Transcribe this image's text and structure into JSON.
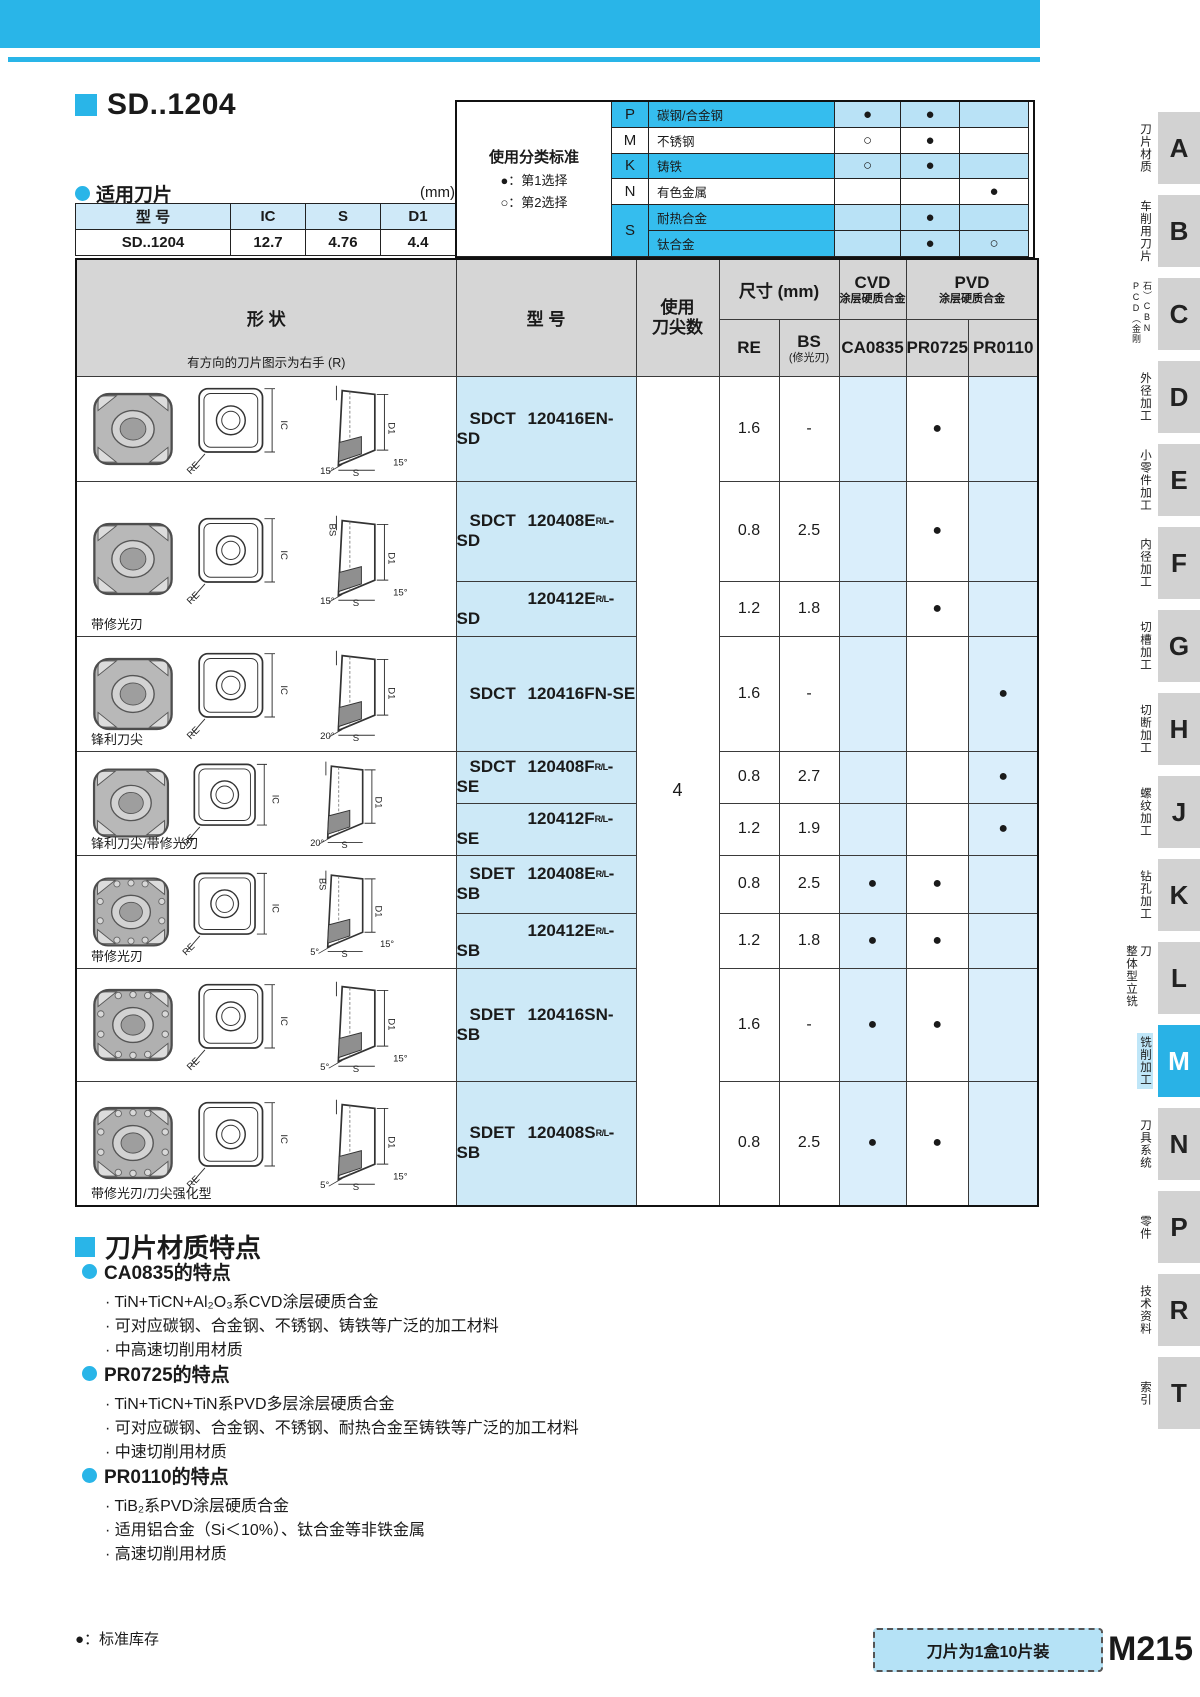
{
  "title": {
    "heading": "SD..1204",
    "applicable_label": "适用刀片",
    "unit": "(mm)"
  },
  "applicable_table": {
    "headers": [
      "型  号",
      "IC",
      "S",
      "D1"
    ],
    "row": [
      "SD..1204",
      "12.7",
      "4.76",
      "4.4"
    ]
  },
  "classification": {
    "title": "使用分类标准",
    "legend1": "●：第1选择",
    "legend2": "○：第2选择",
    "rows": [
      {
        "letter": "P",
        "label": "碳钢/合金钢",
        "marks": [
          "●",
          "●",
          ""
        ]
      },
      {
        "letter": "M",
        "label": "不锈钢",
        "marks": [
          "○",
          "●",
          ""
        ]
      },
      {
        "letter": "K",
        "label": "铸铁",
        "marks": [
          "○",
          "●",
          ""
        ]
      },
      {
        "letter": "N",
        "label": "有色金属",
        "marks": [
          "",
          "",
          "●"
        ]
      },
      {
        "letter": "S",
        "label": "耐热合金",
        "marks": [
          "",
          "●",
          ""
        ]
      },
      {
        "letter": "",
        "label": "钛合金",
        "marks": [
          "",
          "●",
          "○"
        ]
      }
    ]
  },
  "main_table": {
    "headers": {
      "shape": "形  状",
      "shape_note": "有方向的刀片图示为右手 (R)",
      "model": "型  号",
      "tips1": "使用",
      "tips2": "刀尖数",
      "size": "尺寸 (mm)",
      "re": "RE",
      "bs": "BS",
      "bs_sub": "(修光刃)",
      "cvd": "CVD",
      "cvd_sub": "涂层硬质合金",
      "pvd": "PVD",
      "pvd_sub": "涂层硬质合金",
      "ca": "CA0835",
      "p725": "PR0725",
      "p110": "PR0110"
    },
    "tips_value": "4",
    "drawing_labels": {
      "re": "RE",
      "ic": "IC",
      "d1": "D1",
      "s": "S"
    },
    "groups": [
      {
        "label": "",
        "bs_label": "",
        "angle_a": "15°",
        "angle_b": "15°",
        "rows": [
          {
            "prefix": "SDCT",
            "code": "120416EN-SD",
            "rl": "",
            "suffix": "",
            "re": "1.6",
            "bs": "-",
            "ca": "",
            "p725": "●",
            "p110": ""
          }
        ]
      },
      {
        "label": "带修光刃",
        "bs_label": "BS",
        "angle_a": "15°",
        "angle_b": "15°",
        "rows": [
          {
            "prefix": "SDCT",
            "code": "120408E",
            "rl": "R/L",
            "suffix": "-SD",
            "re": "0.8",
            "bs": "2.5",
            "ca": "",
            "p725": "●",
            "p110": ""
          },
          {
            "prefix": "",
            "code": "120412E",
            "rl": "R/L",
            "suffix": "-SD",
            "re": "1.2",
            "bs": "1.8",
            "ca": "",
            "p725": "●",
            "p110": ""
          }
        ]
      },
      {
        "label": "锋利刀尖",
        "bs_label": "",
        "angle_a": "20°",
        "angle_b": "",
        "rows": [
          {
            "prefix": "SDCT",
            "code": "120416FN-SE",
            "rl": "",
            "suffix": "",
            "re": "1.6",
            "bs": "-",
            "ca": "",
            "p725": "",
            "p110": "●"
          }
        ]
      },
      {
        "label": "锋利刀尖/带修光刃",
        "bs_label": "",
        "angle_a": "20°",
        "angle_b": "",
        "rows": [
          {
            "prefix": "SDCT",
            "code": "120408F",
            "rl": "R/L",
            "suffix": "-SE",
            "re": "0.8",
            "bs": "2.7",
            "ca": "",
            "p725": "",
            "p110": "●"
          },
          {
            "prefix": "",
            "code": "120412F",
            "rl": "R/L",
            "suffix": "-SE",
            "re": "1.2",
            "bs": "1.9",
            "ca": "",
            "p725": "",
            "p110": "●"
          }
        ]
      },
      {
        "label": "带修光刃",
        "bs_label": "BS",
        "angle_a": "5°",
        "angle_b": "15°",
        "rows": [
          {
            "prefix": "SDET",
            "code": "120408E",
            "rl": "R/L",
            "suffix": "-SB",
            "re": "0.8",
            "bs": "2.5",
            "ca": "●",
            "p725": "●",
            "p110": ""
          },
          {
            "prefix": "",
            "code": "120412E",
            "rl": "R/L",
            "suffix": "-SB",
            "re": "1.2",
            "bs": "1.8",
            "ca": "●",
            "p725": "●",
            "p110": ""
          }
        ]
      },
      {
        "label": "",
        "bs_label": "",
        "angle_a": "5°",
        "angle_b": "15°",
        "rows": [
          {
            "prefix": "SDET",
            "code": "120416SN-SB",
            "rl": "",
            "suffix": "",
            "re": "1.6",
            "bs": "-",
            "ca": "●",
            "p725": "●",
            "p110": ""
          }
        ]
      },
      {
        "label": "带修光刃/刀尖强化型",
        "bs_label": "",
        "angle_a": "5°",
        "angle_b": "15°",
        "rows": [
          {
            "prefix": "SDET",
            "code": "120408S",
            "rl": "R/L",
            "suffix": "-SB",
            "re": "0.8",
            "bs": "2.5",
            "ca": "●",
            "p725": "●",
            "p110": ""
          }
        ]
      }
    ]
  },
  "materials": {
    "heading": "刀片材质特点",
    "sections": [
      {
        "title": "CA0835的特点",
        "bullets": [
          "· TiN+TiCN+Al₂O₃系CVD涂层硬质合金",
          "· 可对应碳钢、合金钢、不锈钢、铸铁等广泛的加工材料",
          "· 中高速切削用材质"
        ]
      },
      {
        "title": "PR0725的特点",
        "bullets": [
          "· TiN+TiCN+TiN系PVD多层涂层硬质合金",
          "· 可对应碳钢、合金钢、不锈钢、耐热合金至铸铁等广泛的加工材料",
          "· 中速切削用材质"
        ]
      },
      {
        "title": "PR0110的特点",
        "bullets": [
          "· TiB₂系PVD涂层硬质合金",
          "· 适用铝合金（Si＜10%）、钛合金等非铁金属",
          "· 高速切削用材质"
        ]
      }
    ]
  },
  "footer": {
    "stock_note": "●：标准库存",
    "pack_note": "刀片为1盒10片装",
    "page_code": "M215"
  },
  "sidebar": {
    "tabs": [
      {
        "letter": "A",
        "label": "刀片材质"
      },
      {
        "letter": "B",
        "label": "车削用刀片"
      },
      {
        "letter": "C",
        "label": "PCD（金刚石）CBN"
      },
      {
        "letter": "D",
        "label": "外径加工"
      },
      {
        "letter": "E",
        "label": "小零件加工"
      },
      {
        "letter": "F",
        "label": "内径加工"
      },
      {
        "letter": "G",
        "label": "切槽加工"
      },
      {
        "letter": "H",
        "label": "切断加工"
      },
      {
        "letter": "J",
        "label": "螺纹加工"
      },
      {
        "letter": "K",
        "label": "钻孔加工"
      },
      {
        "letter": "L",
        "label": "整体型立铣刀"
      },
      {
        "letter": "M",
        "label": "铣削加工"
      },
      {
        "letter": "N",
        "label": "刀具系统"
      },
      {
        "letter": "P",
        "label": "零件"
      },
      {
        "letter": "R",
        "label": "技术资料"
      },
      {
        "letter": "T",
        "label": "索引"
      }
    ]
  }
}
